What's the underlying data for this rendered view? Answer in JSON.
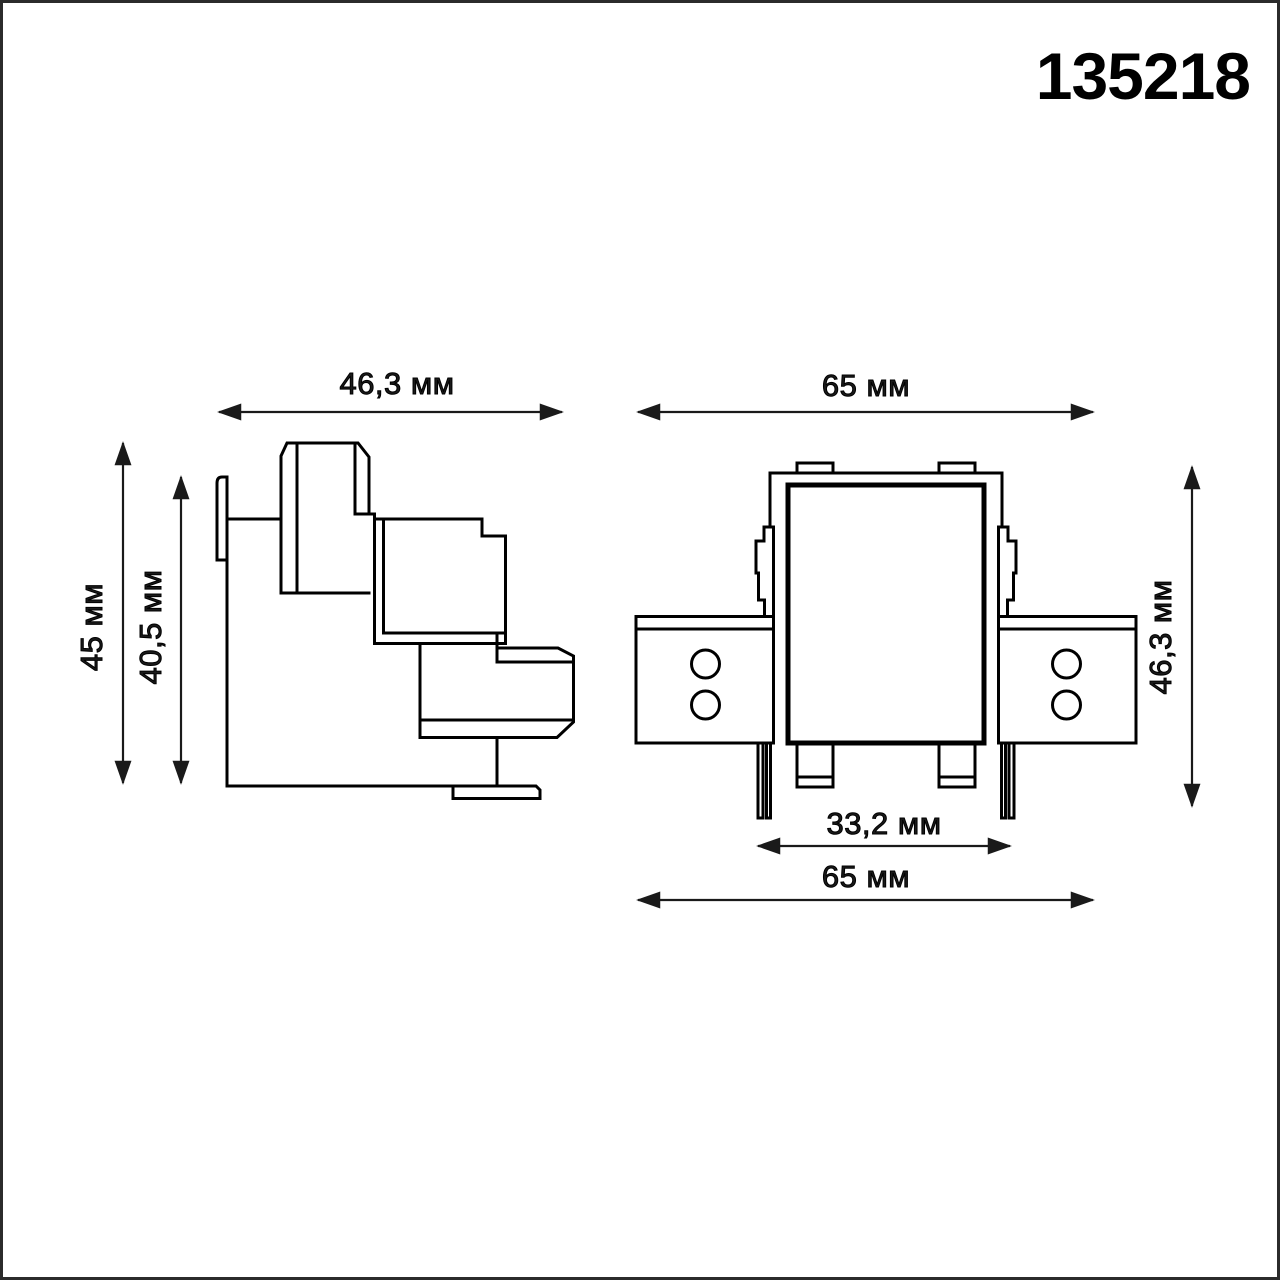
{
  "colors": {
    "line": "#000000",
    "text": "#1a1a1a",
    "frame": "#2b2b2b",
    "background": "#ffffff"
  },
  "header": {
    "article_number": "135218"
  },
  "side_view": {
    "label": "side profile view",
    "dimensions": {
      "width_top": "46,3 мм",
      "height_overall": "45 мм",
      "height_inner": "40,5 мм"
    }
  },
  "front_view": {
    "label": "front view",
    "dimensions": {
      "width_top": "65 мм",
      "height_right": "46,3 мм",
      "width_inner_bottom": "33,2 мм",
      "width_bottom": "65 мм"
    }
  }
}
